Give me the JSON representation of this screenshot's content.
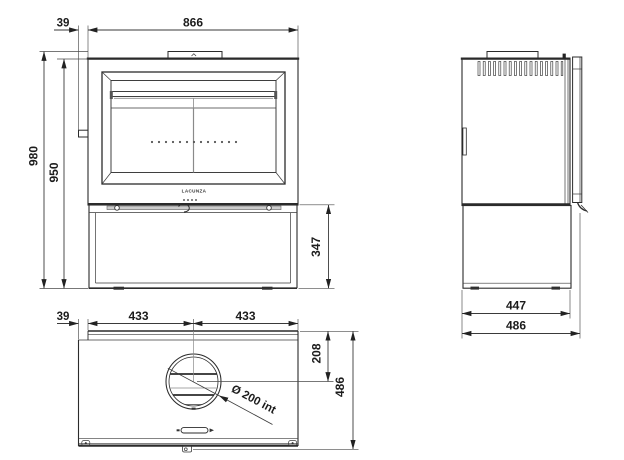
{
  "drawing": {
    "brand": "LACUNZA",
    "front_view": {
      "offset": "39",
      "width": "866",
      "height_total": "980",
      "height_body": "950",
      "base_height": "347"
    },
    "side_view": {
      "depth_body": "447",
      "depth_total": "486"
    },
    "top_view": {
      "offset": "39",
      "half_width_left": "433",
      "half_width_right": "433",
      "flue_center_offset": "208",
      "depth": "486",
      "flue_diameter_label": "Ø 200 int"
    }
  }
}
